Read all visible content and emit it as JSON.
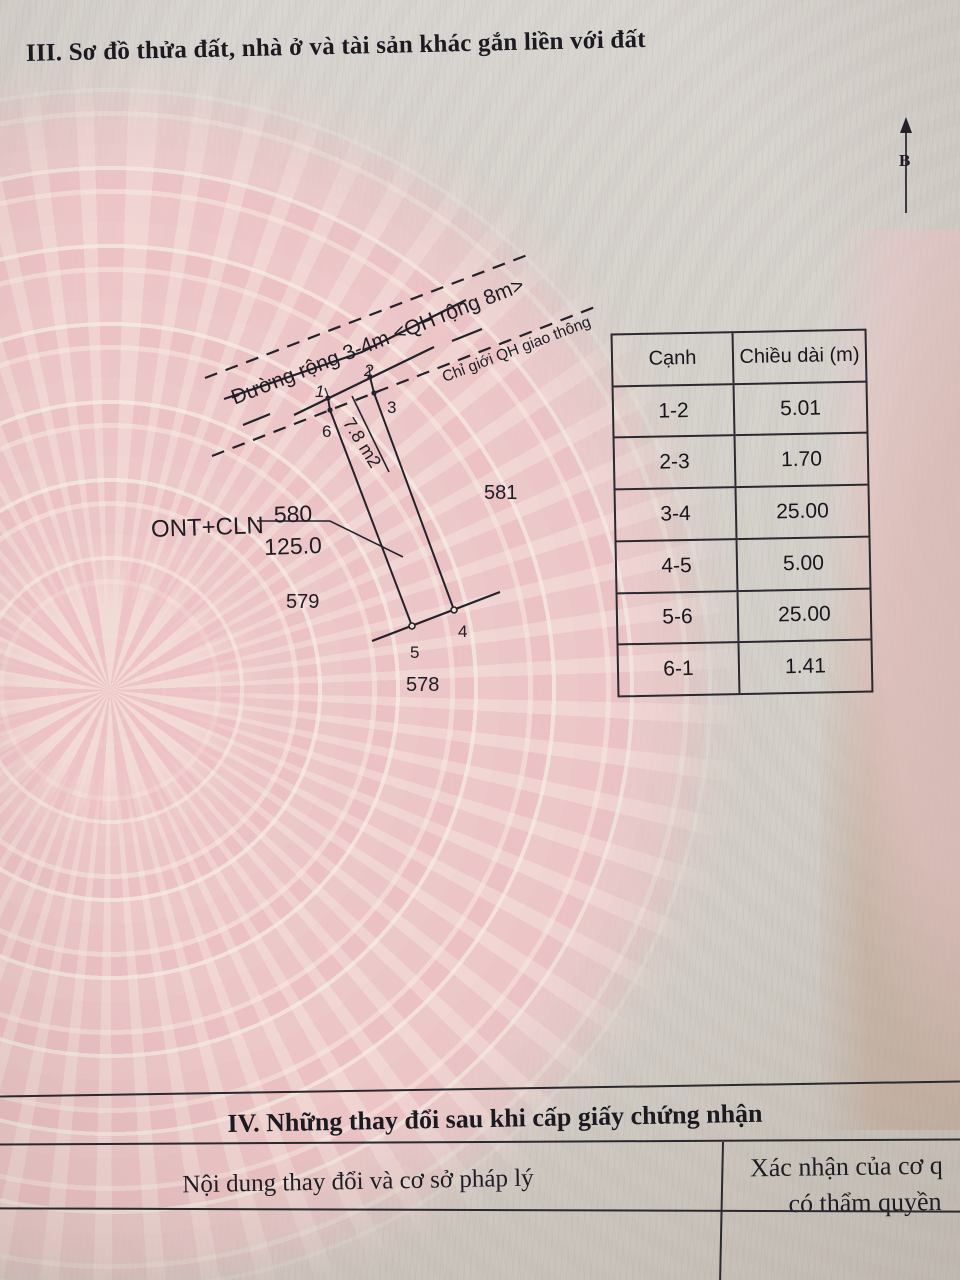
{
  "section3": {
    "title": "III. Sơ đồ thửa đất, nhà ở và tài sản khác gắn liền với đất"
  },
  "diagram": {
    "north_label": "B",
    "road_label": "Đường rộng 3-4m <QH rộng 8m>",
    "qh_boundary_label": "Chỉ giới QH giao thông",
    "strip_area_label": "7.8 m2",
    "land_use_code": "ONT+CLN",
    "parcel": {
      "number": "580",
      "area": "125.0"
    },
    "neighbors": {
      "left": "579",
      "right": "581",
      "bottom": "578"
    },
    "vertices": {
      "v1": "1",
      "v2": "2",
      "v3": "3",
      "v4": "4",
      "v5": "5",
      "v6": "6"
    }
  },
  "edge_table": {
    "headers": {
      "edge": "Cạnh",
      "length": "Chiều dài (m)"
    },
    "rows": [
      {
        "edge": "1-2",
        "length": "5.01"
      },
      {
        "edge": "2-3",
        "length": "1.70"
      },
      {
        "edge": "3-4",
        "length": "25.00"
      },
      {
        "edge": "4-5",
        "length": "5.00"
      },
      {
        "edge": "5-6",
        "length": "25.00"
      },
      {
        "edge": "6-1",
        "length": "1.41"
      }
    ]
  },
  "section4": {
    "title": "IV. Những thay đổi sau khi cấp giấy chứng nhận",
    "left_header": "Nội dung thay đổi và cơ sở pháp lý",
    "right_header_line1": "Xác nhận của cơ q",
    "right_header_line2": "có thẩm quyền"
  }
}
